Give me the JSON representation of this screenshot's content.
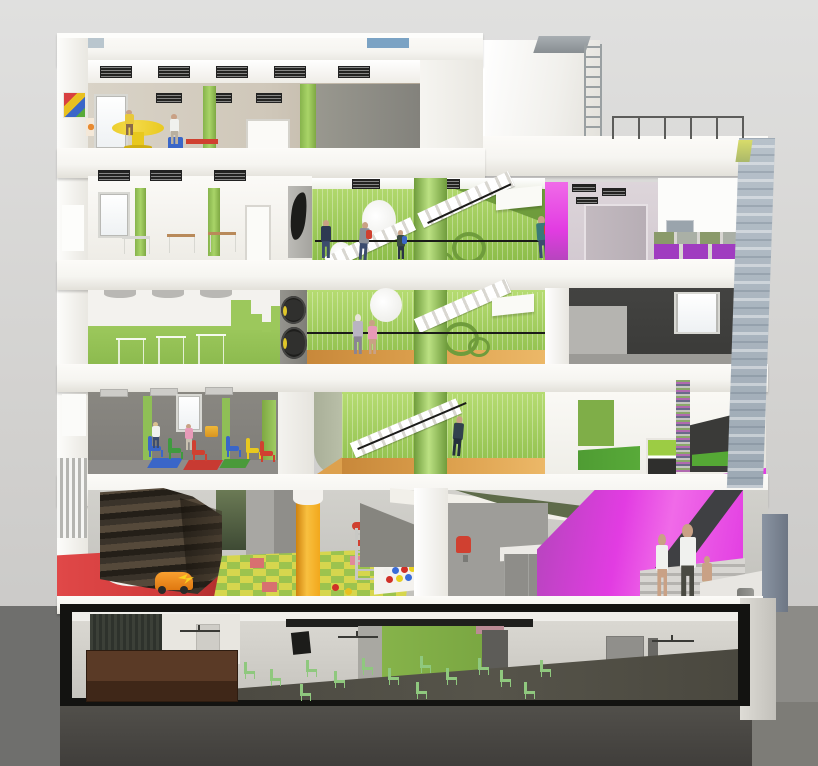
{
  "meta": {
    "kind": "architectural-section-rendering",
    "subject": "multi-storey children's center cutaway section",
    "canvas": {
      "width": 818,
      "height": 766
    },
    "visible_text": "none"
  },
  "scene": {
    "floors": [
      {
        "id": "roof",
        "elements": [
          "penthouse-volume",
          "roof-ladder-icon",
          "roof-railing"
        ]
      },
      {
        "id": "floor-5",
        "label_semantic": "top-floor playroom",
        "elements": [
          "ceiling-vents",
          "wall-poster",
          "window",
          "yellow-play-table",
          "red-table",
          "blue-chair",
          "children",
          "green-pilasters",
          "gray-partition"
        ]
      },
      {
        "id": "floor-4",
        "label_semantic": "classroom + stair hall",
        "elements": [
          "sketch-desks",
          "green-stairwell",
          "white-stairs",
          "running-children",
          "magenta-wall-strip",
          "lavender-corridor",
          "storage-cubbies"
        ]
      },
      {
        "id": "floor-3",
        "label_semantic": "classroom with green skyline wall + stair hall",
        "elements": [
          "ghost-furniture",
          "porthole-discs",
          "stairs",
          "children",
          "dark-gray-room",
          "window"
        ]
      },
      {
        "id": "floor-2",
        "label_semantic": "gray playroom + stair hall + green rooms",
        "elements": [
          "kids-chairs",
          "floor-mats",
          "stairs",
          "striped-column",
          "green-floor-room",
          "cabinet"
        ]
      },
      {
        "id": "ground-floor",
        "label_semantic": "double-height play hall and entry",
        "elements": [
          "slat-screen",
          "rock-climbing-wall",
          "crash-mats",
          "red-floor",
          "toy-car",
          "checker-play-mat",
          "orange-column",
          "climbing-frame",
          "ball-pit",
          "reception-counter",
          "red-chair",
          "magenta-entry-wall",
          "entry-stair",
          "family-figures",
          "waste-bin",
          "fence-panel"
        ]
      },
      {
        "id": "basement",
        "label_semantic": "auditorium / multi-purpose hall",
        "elements": [
          "stage",
          "wood-floor",
          "speaker",
          "green-accent-wall",
          "ceiling-fans",
          "rows-of-green-chairs",
          "doors"
        ]
      }
    ]
  },
  "palette": {
    "sky_top": "#e0e0df",
    "sky_mid": "#d2d1cf",
    "sky_bot": "#c6c5c3",
    "ground_left": "#6f6f6d",
    "ground_right": "#8c8b87",
    "ground_under": "#53514c",
    "ground_under_dark": "#403e3b",
    "ground_right_under": "#7d7c77",
    "shell": "#f6f5f1",
    "shell_dim": "#e6e4de",
    "beige": "#cfc7b9",
    "beige_dark": "#b1a695",
    "green_wall": "#9cc85c",
    "green_light": "#bce183",
    "green_dark": "#6f9c3c",
    "green_floor": "#58aa39",
    "green_chair": "#8fc87e",
    "green_basement": "#7aa742",
    "sage": "#b9bfa8",
    "olive_wedge": "#5e6b4a",
    "orange_floor": "#dda14e",
    "orange_col": "#f2a81c",
    "orange_col_dark": "#cf820e",
    "magenta": "#e23ce2",
    "magenta_light": "#f06ae8",
    "magenta_deep": "#b445bc",
    "purple_cubby": "#a03cc0",
    "lavender": "#d3cad1",
    "lavender_door": "#b7aeb5",
    "gray_wall": "#8e8d89",
    "gray_mid": "#7e7c78",
    "gray_dark": "#4a4a47",
    "gray_deep": "#3a3a38",
    "charcoal": "#232321",
    "red_floor": "#d23c3c",
    "red_item": "#d04030",
    "blue_item": "#3a66c8",
    "yellow_item": "#e8c81e",
    "rock_a": "#3a332a",
    "rock_b": "#241f18",
    "rock_c": "#55493a",
    "wood": "#5a3a26",
    "wood_dark": "#3f2718",
    "facade_blue": "#aeb9c4",
    "sky_sliver": "#7ba3c4",
    "sky_sliver_light": "#b9c6ce",
    "skin": "#c9a185",
    "denim": "#3c4c6e",
    "white_cloth": "#f0f1ee",
    "pink_cloth": "#e89ab8",
    "mat_g": "#9cc34e",
    "mat_y": "#d6d64e",
    "mat_r": "#d87070",
    "fence": "#7e8896"
  }
}
